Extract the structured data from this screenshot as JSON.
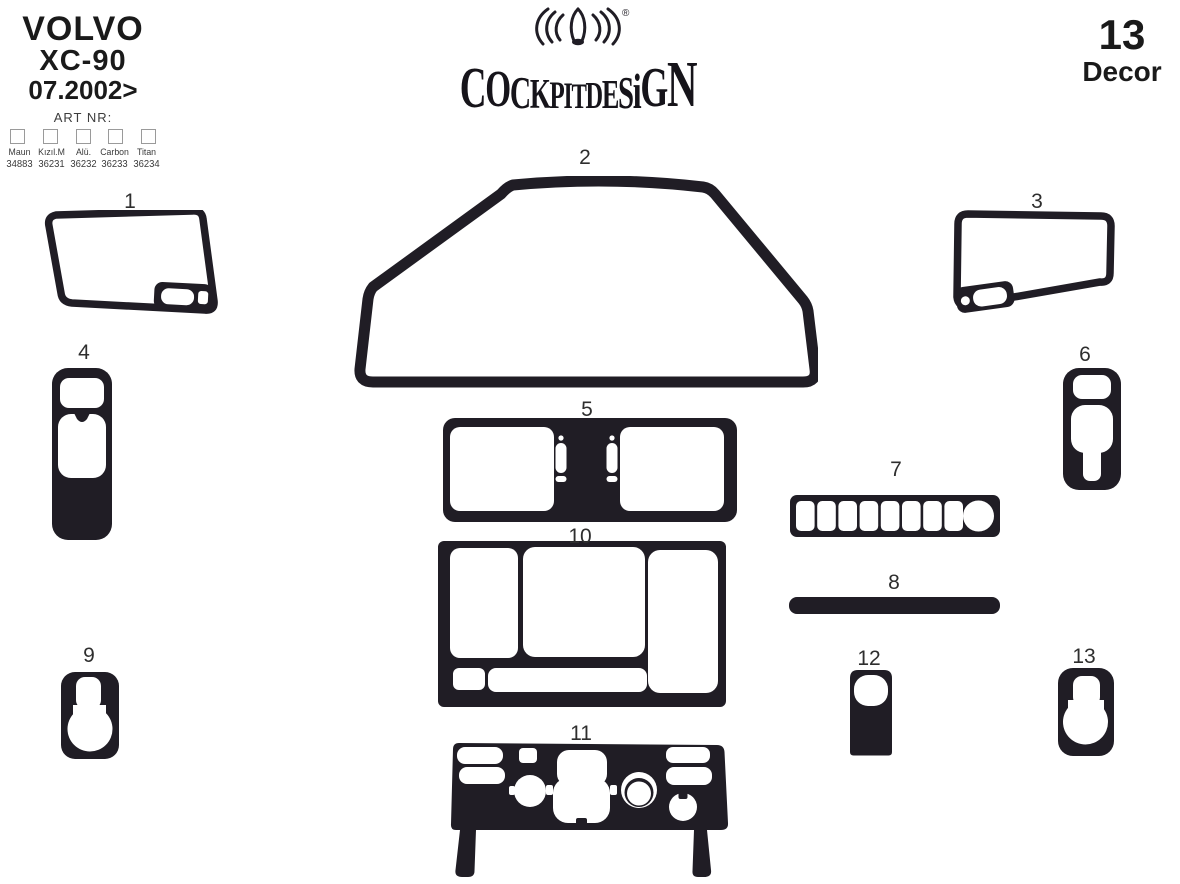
{
  "colors": {
    "ink": "#201d25",
    "background": "#ffffff"
  },
  "header": {
    "vehicle": {
      "make": "VOLVO",
      "model": "XC-90",
      "date": "07.2002>"
    },
    "art_nr_label": "ART NR:",
    "finishes": [
      {
        "name": "Maun",
        "code": "34883"
      },
      {
        "name": "Kızıl.M",
        "code": "36231"
      },
      {
        "name": "Alü.",
        "code": "36232"
      },
      {
        "name": "Carbon",
        "code": "36233"
      },
      {
        "name": "Titan",
        "code": "36234"
      }
    ],
    "logo": {
      "text": "COCKPITDESiGN",
      "registered": "®"
    },
    "decor_count": "13",
    "decor_label": "Decor"
  },
  "pieces": [
    {
      "number": "1"
    },
    {
      "number": "2"
    },
    {
      "number": "3"
    },
    {
      "number": "4"
    },
    {
      "number": "5"
    },
    {
      "number": "6"
    },
    {
      "number": "7"
    },
    {
      "number": "8"
    },
    {
      "number": "9"
    },
    {
      "number": "10"
    },
    {
      "number": "11"
    },
    {
      "number": "12"
    },
    {
      "number": "13"
    }
  ]
}
